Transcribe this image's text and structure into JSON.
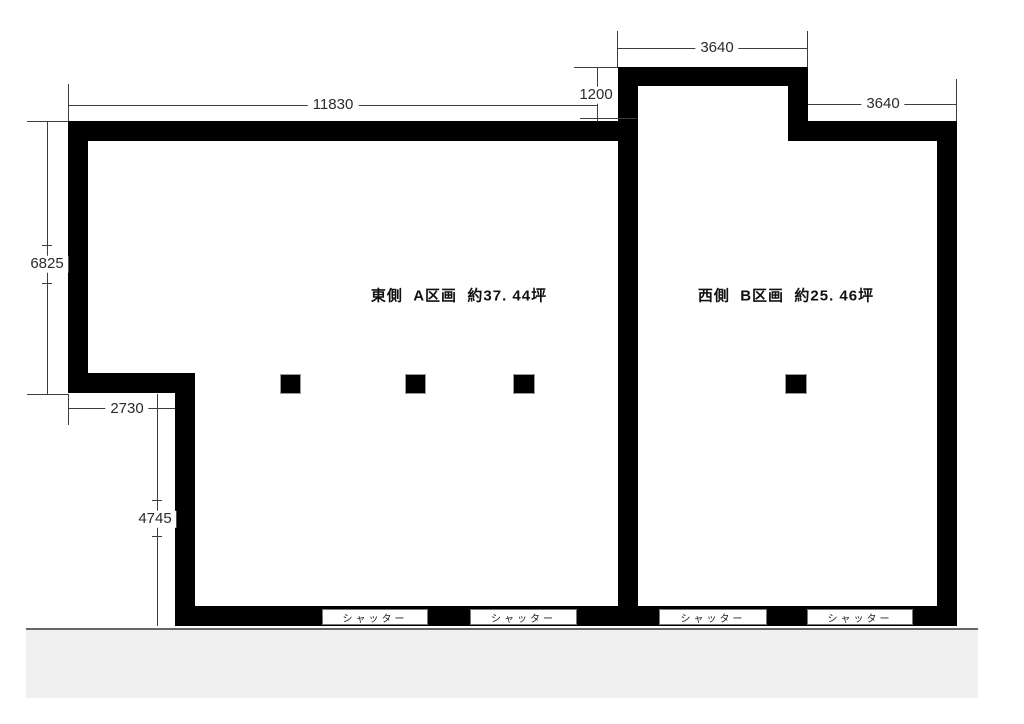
{
  "plan": {
    "rooms": {
      "east": {
        "label": "東側  A区画  約37. 44坪"
      },
      "west": {
        "label": "西側  B区画  約25. 46坪"
      }
    },
    "dimensions": {
      "top_width": "11830",
      "notch_offset": "1200",
      "protrusion_top_width": "3640",
      "right_top_width": "3640",
      "left_upper_height": "6825",
      "left_jog_width": "2730",
      "left_lower_height": "4745"
    },
    "shutters": [
      "シャッター",
      "シャッター",
      "シャッター",
      "シャッター"
    ],
    "colors": {
      "wall": "#000000",
      "road_fill": "#f0f0f0",
      "dim_line": "#3d3d3d"
    }
  }
}
